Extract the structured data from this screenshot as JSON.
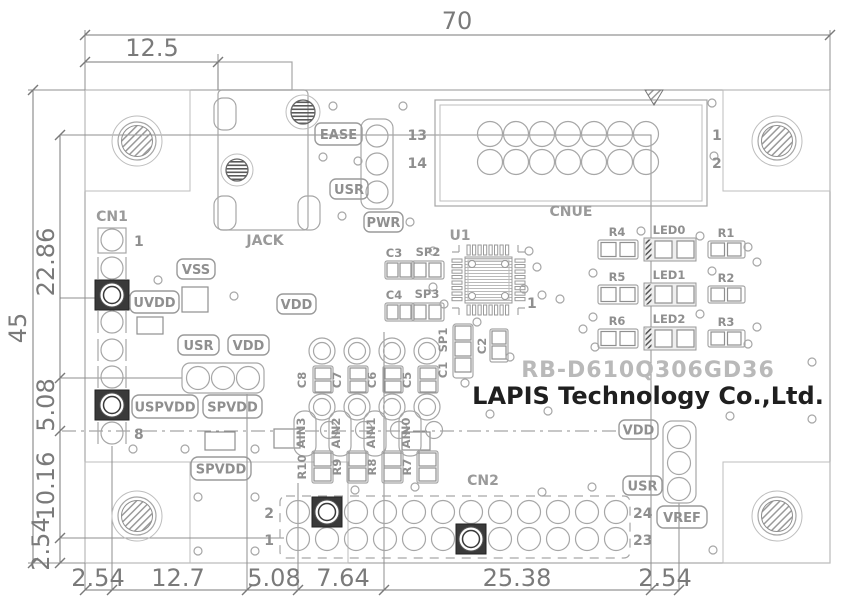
{
  "colors": {
    "silkscreen": "#a6a6a6",
    "dimension": "#7a7a7a",
    "dark_pad": "#3a3a3a",
    "part_number_gray": "#b9b9b9",
    "company_text": "#1f1f1f",
    "background": "#ffffff"
  },
  "dims": {
    "width_total": "70",
    "jack_offset": "12.5",
    "height_total": "45",
    "left": [
      "22.86",
      "5.08",
      "10.16",
      "2.54"
    ],
    "bottom": [
      "2.54",
      "12.7",
      "5.08",
      "7.64",
      "25.38",
      "2.54"
    ]
  },
  "branding": {
    "part_number": "RB-D610Q306GD36",
    "company": "LAPIS Technology Co.,Ltd."
  },
  "labels": {
    "ease": "EASE",
    "usr_top": "USR",
    "pwr": "PWR",
    "vss": "VSS",
    "uvdd": "UVDD",
    "vdd_jack": "VDD",
    "usr_mid": "USR",
    "vdd_mid": "VDD",
    "uspvdd": "USPVDD",
    "spvdd_a": "SPVDD",
    "spvdd_b": "SPVDD",
    "vdd_right": "VDD",
    "usr_right": "USR",
    "vref": "VREF"
  },
  "refdes": {
    "cn1": "CN1",
    "jack": "JACK",
    "u1": "U1",
    "cnue": "CNUE",
    "cn2": "CN2",
    "c1": "C1",
    "c2": "C2",
    "c3": "C3",
    "c4": "C4",
    "sp1": "SP1",
    "sp2": "SP2",
    "sp3": "SP3"
  },
  "pins": {
    "cn1_first": "1",
    "cn1_last": "8",
    "cnue_left_top": "13",
    "cnue_left_bottom": "14",
    "cnue_right_top": "1",
    "cnue_right_bottom": "2",
    "cn2_left_top": "2",
    "cn2_left_bottom": "1",
    "cn2_right_top": "24",
    "cn2_right_bottom": "23",
    "u1_pin1": "1"
  },
  "analog": {
    "caps": [
      "C8",
      "C7",
      "C6",
      "C5"
    ],
    "nets": [
      "AIN3",
      "AIN2",
      "AIN1",
      "AIN0"
    ],
    "resistors": [
      "R10",
      "R9",
      "R8",
      "R7"
    ]
  },
  "led_block": {
    "rows": [
      {
        "r_left": "R4",
        "led": "LED0",
        "r_right": "R1"
      },
      {
        "r_left": "R5",
        "led": "LED1",
        "r_right": "R2"
      },
      {
        "r_left": "R6",
        "led": "LED2",
        "r_right": "R3"
      }
    ]
  }
}
